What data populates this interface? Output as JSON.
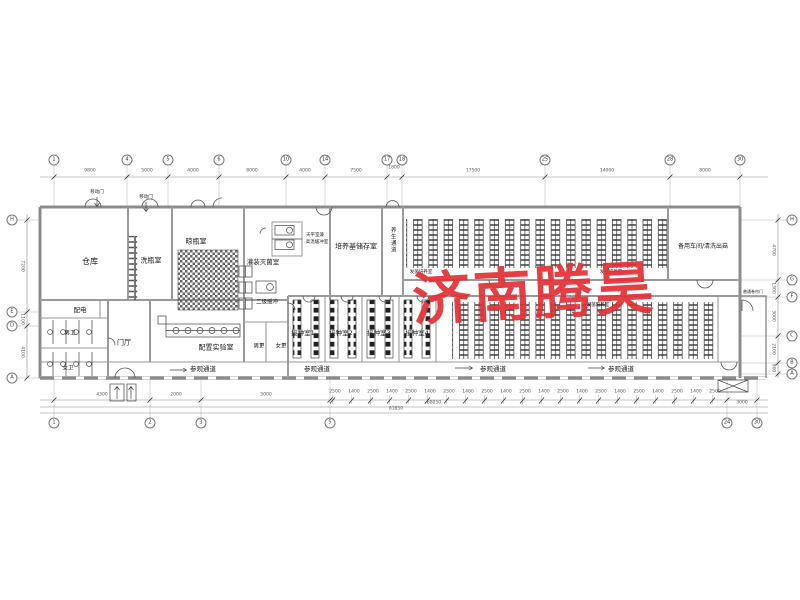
{
  "watermark": {
    "text": "济南腾昊",
    "color": "#e23136"
  },
  "plan": {
    "room_labels": [
      {
        "t": "仓库",
        "x": 90,
        "y": 262,
        "s": 8
      },
      {
        "t": "洗瓶室",
        "x": 151,
        "y": 261,
        "s": 7
      },
      {
        "t": "晾瓶室",
        "x": 196,
        "y": 242,
        "s": 7
      },
      {
        "t": "灌装灭菌室",
        "x": 263,
        "y": 262,
        "s": 6.5
      },
      {
        "t": "天平室兼",
        "x": 315,
        "y": 236,
        "s": 4.5
      },
      {
        "t": "高温缓冲室",
        "x": 317,
        "y": 243,
        "s": 4.5
      },
      {
        "t": "培养基储存室",
        "x": 356,
        "y": 247,
        "s": 7
      },
      {
        "t": "养生通道",
        "x": 392,
        "y": 240,
        "s": 5.5,
        "vert": true
      },
      {
        "t": "发菌培养室",
        "x": 421,
        "y": 273,
        "s": 4.5
      },
      {
        "t": "发菌培养室",
        "x": 611,
        "y": 273,
        "s": 4.5
      },
      {
        "t": "发菌培养室",
        "x": 598,
        "y": 306,
        "s": 4.5
      },
      {
        "t": "备用车间/清洗出菇",
        "x": 703,
        "y": 247,
        "s": 6
      },
      {
        "t": "二级缓冲",
        "x": 267,
        "y": 303,
        "s": 5.5
      },
      {
        "t": "接种室1",
        "x": 303,
        "y": 333,
        "s": 6.5
      },
      {
        "t": "接种室2",
        "x": 341,
        "y": 333,
        "s": 6.5
      },
      {
        "t": "接种室3",
        "x": 379,
        "y": 333,
        "s": 6.5
      },
      {
        "t": "接种室4",
        "x": 417,
        "y": 333,
        "s": 6.5
      },
      {
        "t": "男更",
        "x": 259,
        "y": 347,
        "s": 5.5
      },
      {
        "t": "女更",
        "x": 281,
        "y": 347,
        "s": 5.5
      },
      {
        "t": "配电",
        "x": 80,
        "y": 310,
        "s": 6.5
      },
      {
        "t": "男卫",
        "x": 70,
        "y": 334,
        "s": 5.5
      },
      {
        "t": "女卫",
        "x": 68,
        "y": 369,
        "s": 5.5
      },
      {
        "t": "门厅",
        "x": 124,
        "y": 343,
        "s": 7
      },
      {
        "t": "配置实验室",
        "x": 216,
        "y": 348,
        "s": 7
      },
      {
        "t": "参观通道",
        "x": 203,
        "y": 369,
        "s": 6.5
      },
      {
        "t": "参观通道",
        "x": 317,
        "y": 369,
        "s": 6.5
      },
      {
        "t": "参观通道",
        "x": 493,
        "y": 369,
        "s": 6.5
      },
      {
        "t": "参观通道",
        "x": 621,
        "y": 369,
        "s": 6.5
      }
    ],
    "door_labels": [
      {
        "t": "移动门",
        "x": 97,
        "y": 193,
        "s": 4.5
      },
      {
        "t": "移动门",
        "x": 146,
        "y": 198,
        "s": 4.5
      },
      {
        "t": "普通卷帘门",
        "x": 753,
        "y": 292,
        "s": 4
      }
    ],
    "axes": {
      "top": [
        {
          "n": "1",
          "x": 54,
          "y": 160
        },
        {
          "n": "4",
          "x": 127,
          "y": 160
        },
        {
          "n": "5",
          "x": 168,
          "y": 160
        },
        {
          "n": "6",
          "x": 219,
          "y": 160
        },
        {
          "n": "10",
          "x": 286,
          "y": 160
        },
        {
          "n": "14",
          "x": 325,
          "y": 160
        },
        {
          "n": "17",
          "x": 387,
          "y": 160
        },
        {
          "n": "18",
          "x": 402,
          "y": 160
        },
        {
          "n": "25",
          "x": 545,
          "y": 160
        },
        {
          "n": "28",
          "x": 670,
          "y": 160
        },
        {
          "n": "30",
          "x": 740,
          "y": 160
        }
      ],
      "bottom": [
        {
          "n": "1",
          "x": 54,
          "y": 423
        },
        {
          "n": "2",
          "x": 150,
          "y": 423
        },
        {
          "n": "3",
          "x": 201,
          "y": 423
        },
        {
          "n": "5",
          "x": 330,
          "y": 423
        },
        {
          "n": "24",
          "x": 727,
          "y": 423
        },
        {
          "n": "30",
          "x": 757,
          "y": 423
        }
      ],
      "left": [
        {
          "n": "H",
          "x": 12,
          "y": 220
        },
        {
          "n": "E",
          "x": 12,
          "y": 312
        },
        {
          "n": "D",
          "x": 12,
          "y": 326
        },
        {
          "n": "A",
          "x": 12,
          "y": 378
        }
      ],
      "right": [
        {
          "n": "H",
          "x": 792,
          "y": 220
        },
        {
          "n": "G",
          "x": 792,
          "y": 280
        },
        {
          "n": "F",
          "x": 792,
          "y": 297
        },
        {
          "n": "C",
          "x": 792,
          "y": 336
        },
        {
          "n": "B",
          "x": 792,
          "y": 363
        },
        {
          "n": "A",
          "x": 792,
          "y": 374
        }
      ]
    },
    "dimensions": {
      "top": [
        {
          "v": "9800",
          "x": 90,
          "y": 174
        },
        {
          "v": "5000",
          "x": 147,
          "y": 174
        },
        {
          "v": "4000",
          "x": 193,
          "y": 174
        },
        {
          "v": "8000",
          "x": 252,
          "y": 174
        },
        {
          "v": "4000",
          "x": 305,
          "y": 174
        },
        {
          "v": "7500",
          "x": 356,
          "y": 174
        },
        {
          "v": "1800",
          "x": 394,
          "y": 171
        },
        {
          "v": "17500",
          "x": 473,
          "y": 174
        },
        {
          "v": "14000",
          "x": 607,
          "y": 174
        },
        {
          "v": "8000",
          "x": 705,
          "y": 174
        }
      ],
      "bottom": [
        {
          "v": "4300",
          "x": 102,
          "y": 398
        },
        {
          "v": "2000",
          "x": 176,
          "y": 398
        },
        {
          "v": "5000",
          "x": 266,
          "y": 398
        }
      ],
      "windows": [
        {
          "v": "2500",
          "x": 335,
          "y": 395
        },
        {
          "v": "1400",
          "x": 354,
          "y": 395
        },
        {
          "v": "2500",
          "x": 373,
          "y": 395
        },
        {
          "v": "1400",
          "x": 392,
          "y": 395
        },
        {
          "v": "2500",
          "x": 411,
          "y": 395
        },
        {
          "v": "1400",
          "x": 430,
          "y": 395
        },
        {
          "v": "2500",
          "x": 449,
          "y": 395
        },
        {
          "v": "1400",
          "x": 468,
          "y": 395
        },
        {
          "v": "2500",
          "x": 487,
          "y": 395
        },
        {
          "v": "1400",
          "x": 506,
          "y": 395
        },
        {
          "v": "2500",
          "x": 525,
          "y": 395
        },
        {
          "v": "1400",
          "x": 544,
          "y": 395
        },
        {
          "v": "2500",
          "x": 563,
          "y": 395
        },
        {
          "v": "1400",
          "x": 582,
          "y": 395
        },
        {
          "v": "2500",
          "x": 601,
          "y": 395
        },
        {
          "v": "1400",
          "x": 620,
          "y": 395
        },
        {
          "v": "2500",
          "x": 639,
          "y": 395
        },
        {
          "v": "1400",
          "x": 658,
          "y": 395
        },
        {
          "v": "2500",
          "x": 677,
          "y": 395
        },
        {
          "v": "1400",
          "x": 696,
          "y": 395
        },
        {
          "v": "2500",
          "x": 715,
          "y": 395
        }
      ],
      "overall": [
        {
          "v": "68050",
          "x": 434,
          "y": 406
        },
        {
          "v": "3000",
          "x": 742,
          "y": 406
        },
        {
          "v": "81850",
          "x": 396,
          "y": 412
        }
      ],
      "left": [
        {
          "v": "7200",
          "x": 24,
          "y": 266,
          "vert": true
        },
        {
          "v": "1100",
          "x": 24,
          "y": 319,
          "vert": true
        },
        {
          "v": "4100",
          "x": 24,
          "y": 352,
          "vert": true
        }
      ],
      "right": [
        {
          "v": "4700",
          "x": 775,
          "y": 250,
          "vert": true
        },
        {
          "v": "1300",
          "x": 775,
          "y": 288,
          "vert": true
        },
        {
          "v": "3000",
          "x": 775,
          "y": 316,
          "vert": true
        },
        {
          "v": "2100",
          "x": 775,
          "y": 349,
          "vert": true
        },
        {
          "v": "900",
          "x": 775,
          "y": 368,
          "vert": true
        }
      ]
    }
  }
}
